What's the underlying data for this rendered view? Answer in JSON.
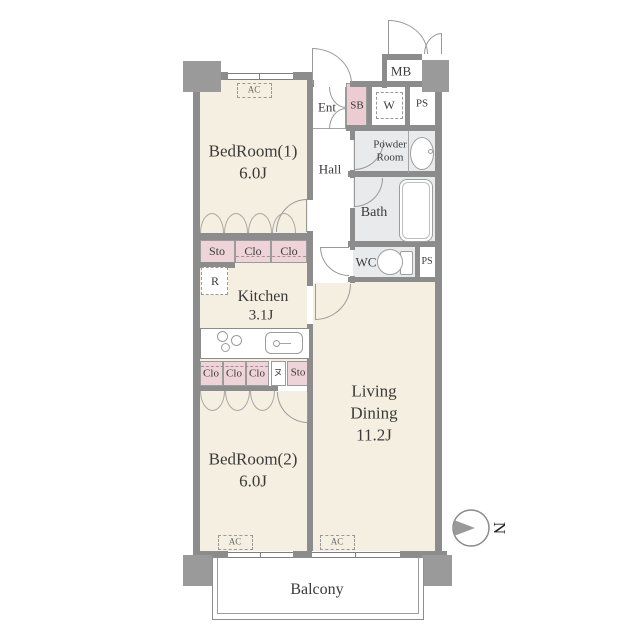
{
  "rooms": {
    "bedroom1": {
      "name": "BedRoom(1)",
      "size": "6.0J"
    },
    "bedroom2": {
      "name": "BedRoom(2)",
      "size": "6.0J"
    },
    "kitchen": {
      "name": "Kitchen",
      "size": "3.1J"
    },
    "living_dining": {
      "name_line1": "Living",
      "name_line2": "Dining",
      "size": "11.2J"
    },
    "hall": "Hall",
    "entrance": "Ent",
    "bath": "Bath",
    "powder_room": {
      "line1": "Powder",
      "line2": "Room"
    },
    "wc": "WC",
    "balcony": "Balcony"
  },
  "fixtures": {
    "shoe_box": "SB",
    "meter_box": "MB",
    "pipe_space_top": "PS",
    "pipe_space_mid": "PS",
    "washer": "W",
    "refrigerator": "R",
    "air_conditioner": "AC",
    "storage_symbol": "ヌ"
  },
  "closets": {
    "row1": [
      "Sto",
      "Clo",
      "Clo"
    ],
    "row2": [
      "Clo",
      "Clo",
      "Clo"
    ],
    "row2_storage": "Sto"
  },
  "compass": {
    "north": "N"
  },
  "colors": {
    "room_fill": "#f5efe1",
    "closet_fill": "#eed3d8",
    "wet_area_fill": "#e8eaec",
    "wall": "#8c8c8c",
    "pillar": "#9a9a9a"
  }
}
